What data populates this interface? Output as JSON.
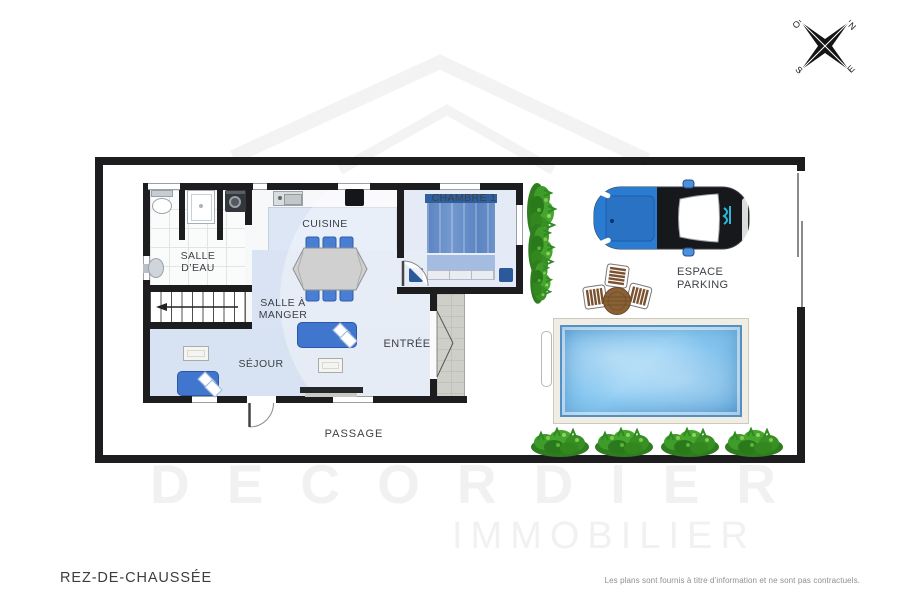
{
  "plan": {
    "floor_label": "REZ-DE-CHAUSSÉE",
    "disclaimer": "Les plans sont fournis à titre d’information et ne sont pas contractuels.",
    "rooms": {
      "salle_deau": {
        "line1": "SALLE",
        "line2": "D’EAU"
      },
      "cuisine": {
        "label": "CUISINE"
      },
      "salle_a_manger": {
        "line1": "SALLE À",
        "line2": "MANGER"
      },
      "sejour": {
        "label": "SÉJOUR"
      },
      "chambre": {
        "label": "CHAMBRE 1"
      },
      "entree": {
        "label": "ENTRÉE"
      },
      "passage": {
        "label": "PASSAGE"
      },
      "parking": {
        "line1": "ESPACE",
        "line2": "PARKING"
      }
    },
    "compass": {
      "west": "O",
      "north": "N",
      "south": "S",
      "east": "E"
    },
    "watermark": {
      "line1": "DECORDIER",
      "line2": "IMMOBILIER"
    },
    "colors": {
      "wall": "#1d1d1f",
      "floor_blue": "#d9e3f3",
      "chambre_blue": "#d6e0f1",
      "sofa_blue": "#4076ce",
      "pool_water": "#7fc0ea",
      "pool_frame": "#efede4",
      "car_front_blue": "#2a7cd2",
      "car_decal_cyan": "#2bb9dc",
      "plant_green": "#3f9b2c",
      "watermark_gray": "#f1f1f1"
    }
  }
}
